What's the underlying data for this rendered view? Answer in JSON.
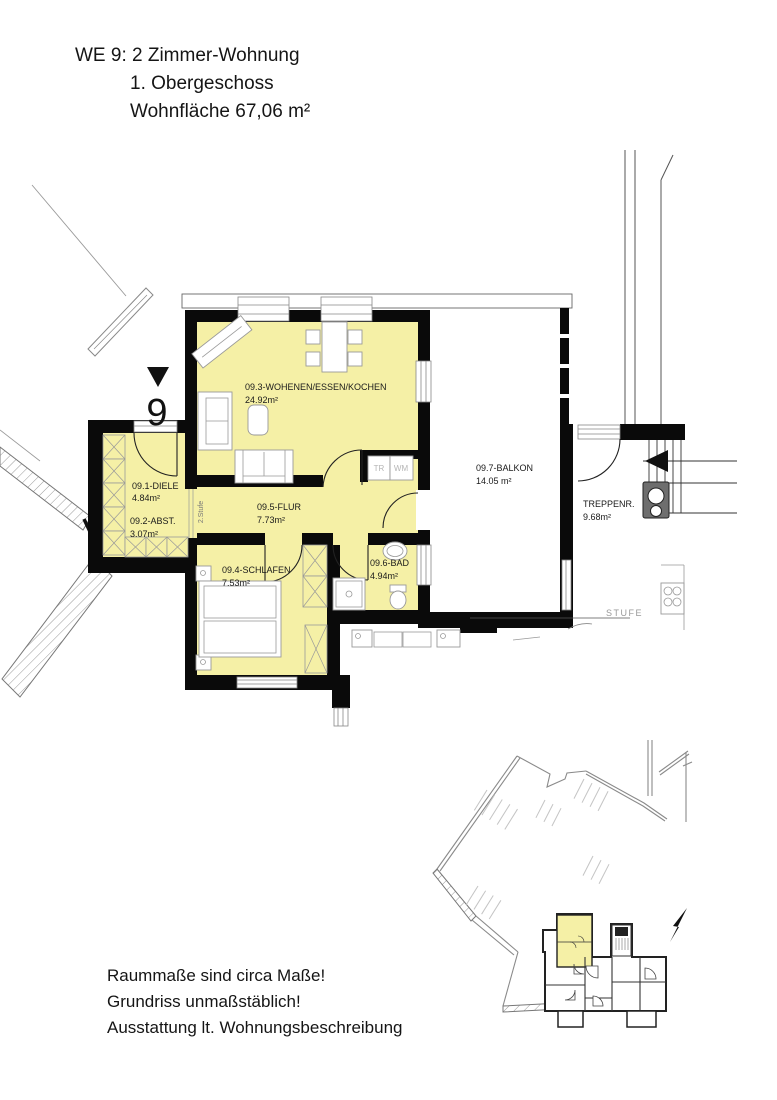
{
  "title": {
    "line1": "WE 9: 2 Zimmer-Wohnung",
    "line2": "1. Obergeschoss",
    "line3": "Wohnfläche 67,06 m²"
  },
  "unit_marker": "9",
  "rooms": [
    {
      "name": "09.1-DIELE",
      "area": "4.84m²"
    },
    {
      "name": "09.2-ABST.",
      "area": "3.07m²"
    },
    {
      "name": "09.3-WOHENEN/ESSEN/KOCHEN",
      "area": "24.92m²"
    },
    {
      "name": "09.4-SCHLAFEN",
      "area": "7.53m²"
    },
    {
      "name": "09.5-FLUR",
      "area": "7.73m²"
    },
    {
      "name": "09.6-BAD",
      "area": "4.94m²"
    },
    {
      "name": "09.7-BALKON",
      "area": "14.05 m²"
    },
    {
      "name": "TREPPENR.",
      "area": "9.68m²"
    }
  ],
  "labels": {
    "tr": "TR",
    "wm": "WM",
    "stufe": "STUFE",
    "zwei_stufe": "2.Stufe"
  },
  "notes": {
    "line1": "Raummaße sind circa Maße!",
    "line2": "Grundriss unmaßstäblich!",
    "line3": "Ausstattung lt. Wohnungsbeschreibung"
  },
  "colors": {
    "room_fill": "#f5f0a6",
    "wall": "#0a0a0a",
    "furniture_stroke": "#999999",
    "muted_text": "#b5b5b5"
  }
}
